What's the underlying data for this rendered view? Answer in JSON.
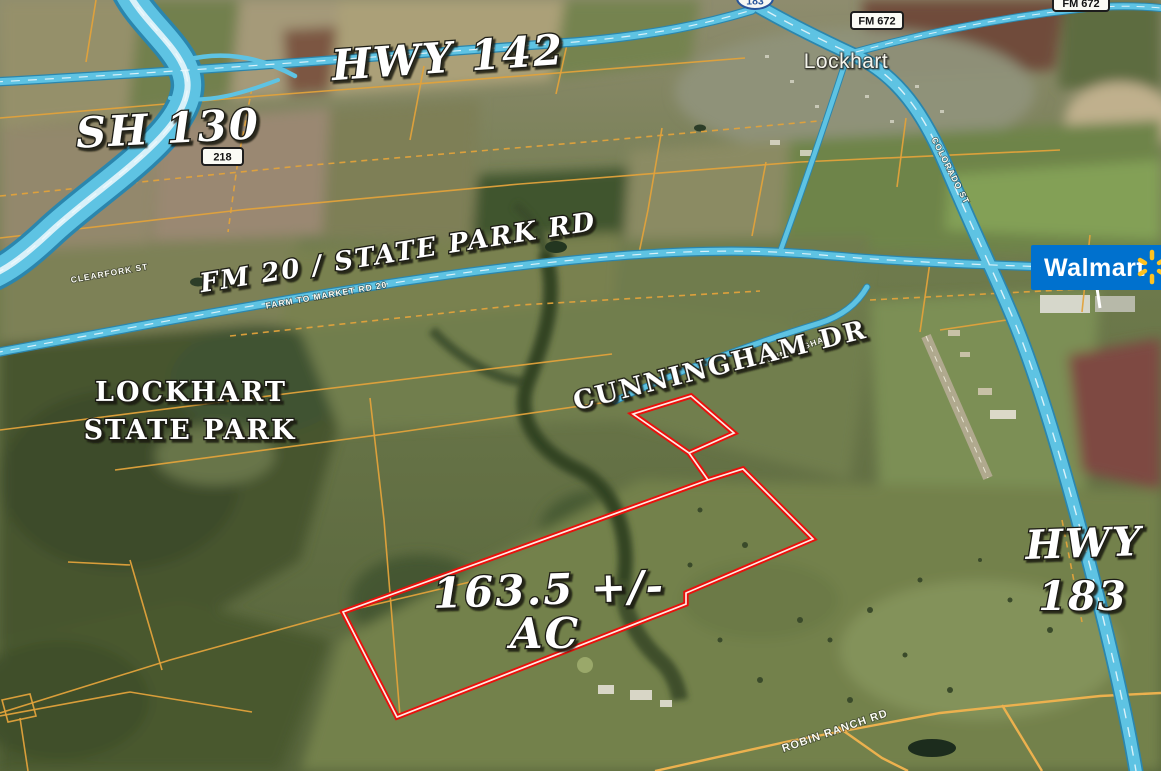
{
  "map": {
    "area_labels": {
      "hwy142": "HWY 142",
      "sh130": "SH 130",
      "fm20_state_park": "FM 20 / STATE PARK RD",
      "cunningham_dr": "CUNNINGHAM DR",
      "acreage_line1": "163.5 +/-",
      "acreage_line2": "AC",
      "hwy183_line1": "HWY",
      "hwy183_line2": "183",
      "state_park_line1": "LOCKHART",
      "state_park_line2": "STATE PARK"
    },
    "town_label": "Lockhart",
    "route_badges": {
      "fm672_lockhart": "FM 672",
      "fm672_northeast": "FM 672",
      "sh218": "218",
      "us183_shield": "183"
    },
    "street_labels": {
      "clearfork": "CLEARFORK ST",
      "farm_to_market": "FARM TO MARKET RD 20",
      "cunningham": "CUNNINGHAM",
      "colorado": "COLORADO ST",
      "robin_ranch": "ROBIN RANCH RD"
    },
    "walmart_logo_text": "Walmart",
    "colors": {
      "highlighted_road": "#5ec3e3",
      "road_casing": "#2b86ad",
      "parcel_line": "#e2a23b",
      "boundary_red": "#e8100c",
      "walmart_blue": "#0071ce",
      "walmart_spark_yellow": "#ffc220"
    }
  }
}
